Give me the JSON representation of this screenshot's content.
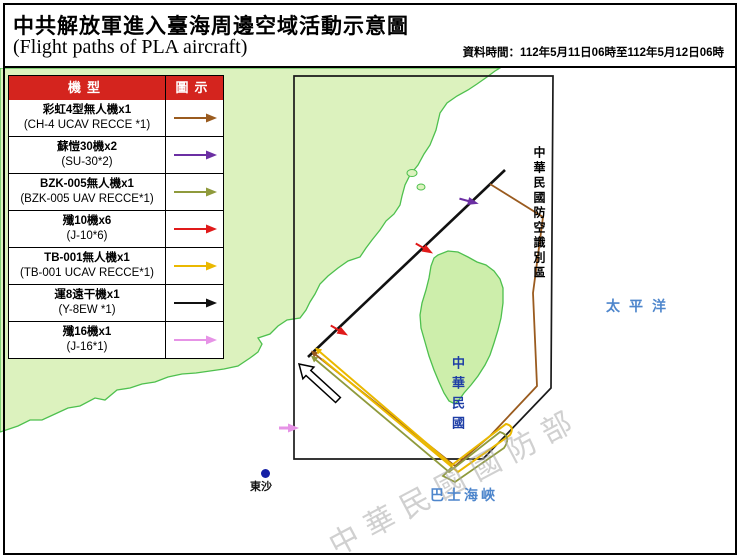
{
  "page": {
    "title_zh": "中共解放軍進入臺海周邊空域活動示意圖",
    "title_en": "(Flight paths of PLA aircraft)",
    "data_time": "資料時間：112年5月11日06時至112年5月12日06時"
  },
  "legend": {
    "header": {
      "type": "機型",
      "symbol": "圖示"
    },
    "rows": [
      {
        "id": "ch4",
        "zh": "彩虹4型無人機x1",
        "en": "(CH-4 UCAV RECCE *1)",
        "color": "#9a5b1f"
      },
      {
        "id": "su30",
        "zh": "蘇愷30機x2",
        "en": "(SU-30*2)",
        "color": "#6b2fa3"
      },
      {
        "id": "bzk005",
        "zh": "BZK-005無人機x1",
        "en": "(BZK-005 UAV RECCE*1)",
        "color": "#8f9a3c"
      },
      {
        "id": "j10",
        "zh": "殲10機x6",
        "en": "(J-10*6)",
        "color": "#e01a1a"
      },
      {
        "id": "tb001",
        "zh": "TB-001無人機x1",
        "en": "(TB-001 UCAV RECCE*1)",
        "color": "#eab800"
      },
      {
        "id": "y8ew",
        "zh": "運8遠干機x1",
        "en": "(Y-8EW *1)",
        "color": "#111111"
      },
      {
        "id": "j16",
        "zh": "殲16機x1",
        "en": "(J-16*1)",
        "color": "#e693e6"
      }
    ]
  },
  "map": {
    "adiz_label": "中華民國防空識別區",
    "taiwan_label": "中華民國",
    "pacific_label": "太平洋",
    "bashi_label": "巴士海峽",
    "dongsha_label": "東沙",
    "watermark": "中華民國國防部"
  },
  "colors": {
    "ch4": "#9a5b1f",
    "su30": "#6b2fa3",
    "bzk005": "#8f9a3c",
    "j10": "#e01a1a",
    "tb001": "#eab800",
    "y8ew": "#111111",
    "j16": "#e693e6",
    "land": "#dcf2be",
    "taiwan_land": "#cdeeab",
    "land_border": "#4ec04e",
    "adiz_line": "#1a1a1a",
    "header_bg": "#d4241e",
    "ocean_label": "#4e86cc",
    "taiwan_label": "#1e3ea6",
    "dongsha_dot": "#1520a6",
    "watermark": "#aaaaaa"
  }
}
